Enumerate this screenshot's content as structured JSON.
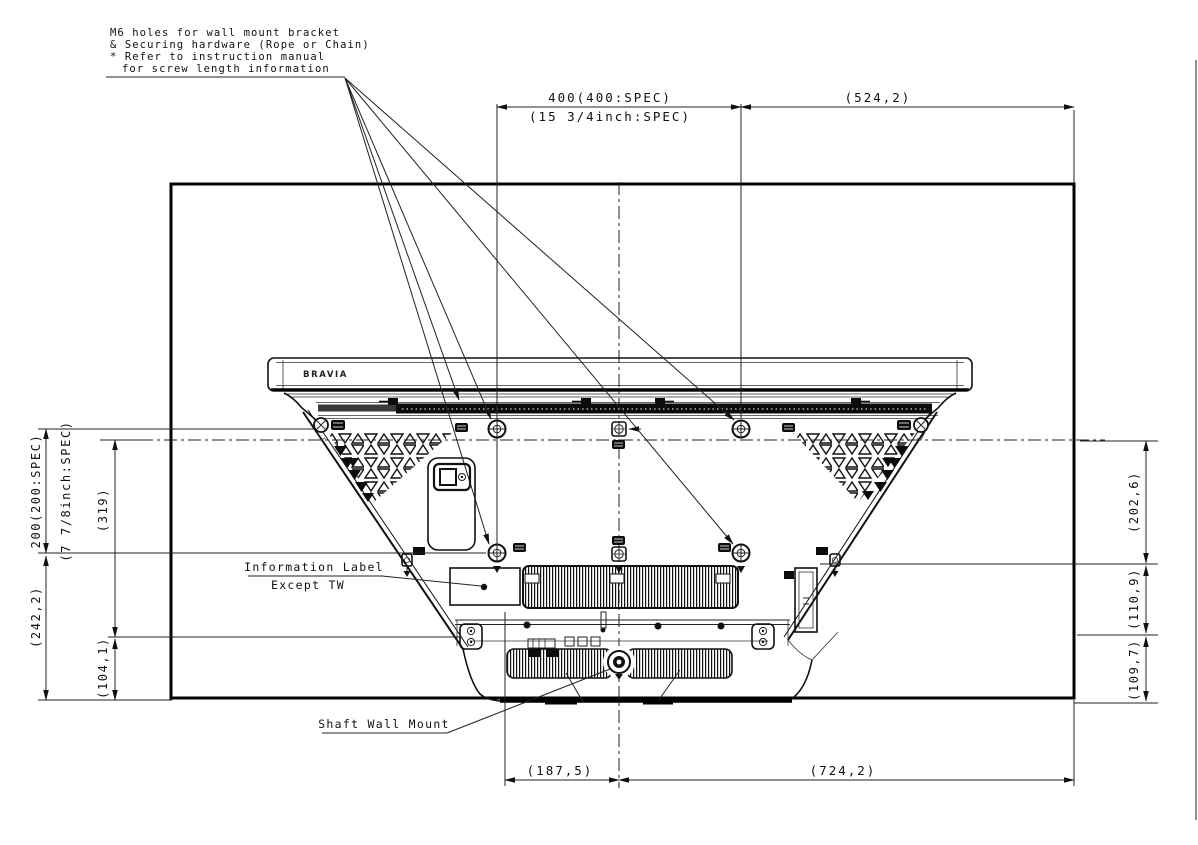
{
  "drawing": {
    "brand": "BRAVIA",
    "callout": {
      "line1": "M6 holes for wall mount bracket",
      "line2": "& Securing hardware (Rope or Chain)",
      "line3": "* Refer to instruction manual",
      "line4": "for screw length information"
    },
    "labels": {
      "info": "Information Label",
      "info_sub": "Except TW",
      "shaft": "Shaft Wall Mount"
    },
    "dims": {
      "top_mm": "400(400:SPEC)",
      "top_inch": "(15 3/4inch:SPEC)",
      "top_right": "(524,2)",
      "left_mm": "200(200:SPEC)",
      "left_inch": "(7 7/8inch:SPEC)",
      "left_319": "(319)",
      "left_242": "(242,2)",
      "left_104": "(104,1)",
      "right_202": "(202,6)",
      "right_110": "(110,9)",
      "right_109": "(109,7)",
      "bottom_187": "(187,5)",
      "bottom_724": "(724,2)"
    }
  }
}
